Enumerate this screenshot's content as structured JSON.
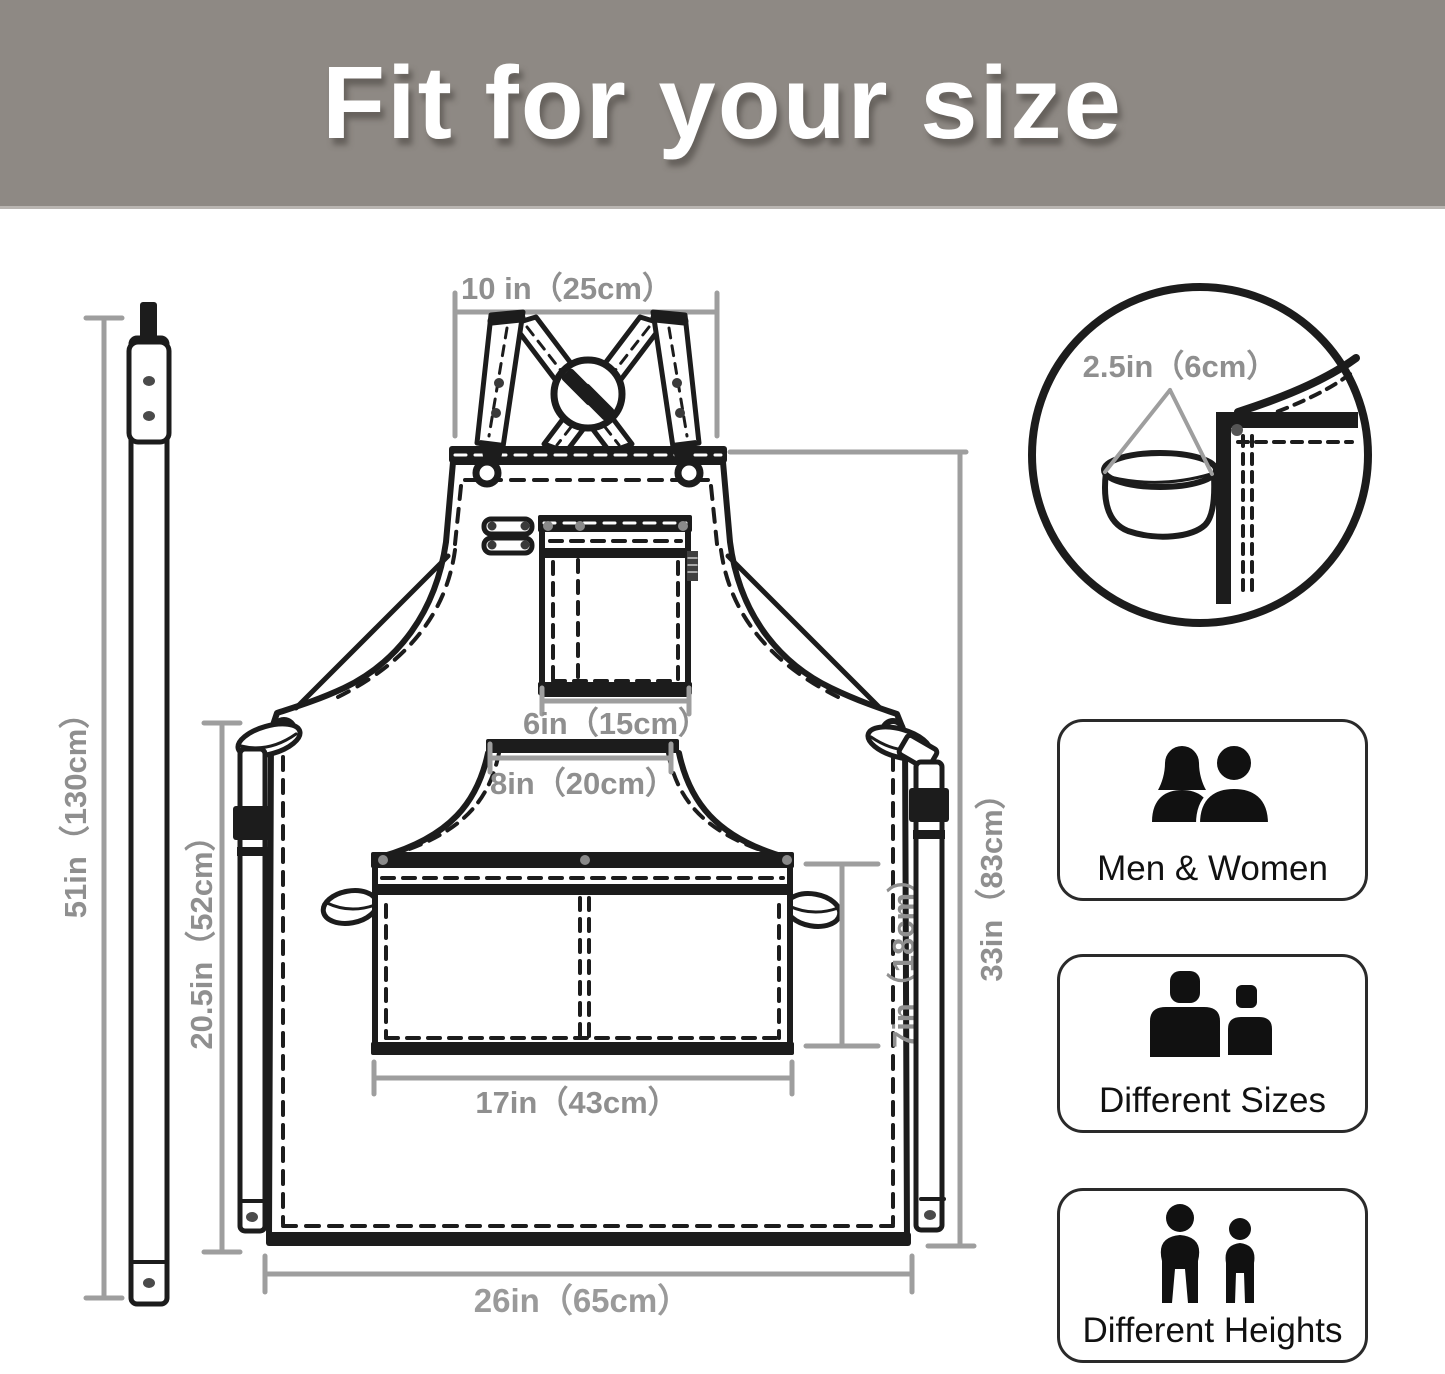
{
  "header": {
    "title": "Fit for your size"
  },
  "colors": {
    "banner_bg": "#8e8984",
    "banner_text": "#ffffff",
    "line_art": "#1c1c1c",
    "dimension_gray": "#9e9e9e",
    "dimension_text_gray": "#8f8f8f"
  },
  "diagram": {
    "dim_labels": {
      "strap_length": "51in（130cm）",
      "neck_strap_width": "10 in（25cm）",
      "loop_width": "2.5in（6cm）",
      "chest_pocket_width": "6in（15cm）",
      "waist_top_width": "8in（20cm）",
      "side_height": "20.5in（52cm）",
      "body_height": "33in（83cm）",
      "front_pocket_height": "7in（18cm）",
      "front_pocket_width": "17in（43cm）",
      "bottom_width": "26in（65cm）"
    }
  },
  "features": [
    {
      "label": "Men & Women"
    },
    {
      "label": "Different Sizes"
    },
    {
      "label": "Different Heights"
    }
  ]
}
